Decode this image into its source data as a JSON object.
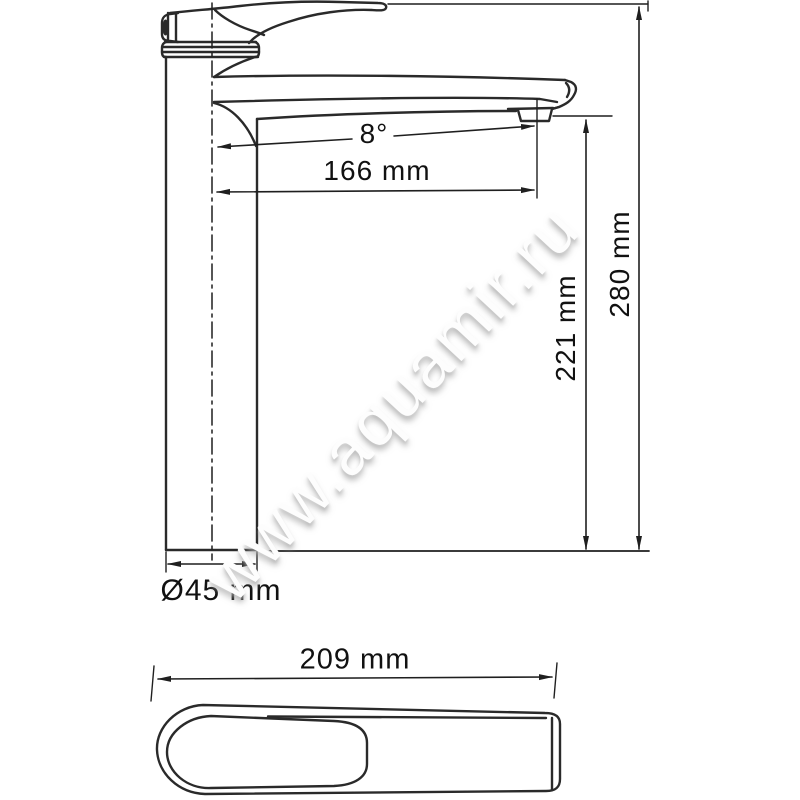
{
  "page": {
    "type": "faucet technical dimension drawing",
    "background": "#ffffff"
  },
  "watermark": {
    "text": "www.aquamir.ru"
  },
  "labels": {
    "spout_angle": "8°",
    "spout_reach": "166 mm",
    "outlet_height": "221 mm",
    "overall_height": "280 mm",
    "base_diameter": "Ø45 mm",
    "overall_length": "209 mm"
  },
  "values": {
    "spout_angle_deg": 8,
    "spout_reach_mm": 166,
    "outlet_height_mm": 221,
    "overall_height_mm": 280,
    "base_diameter_mm": 45,
    "overall_length_mm": 209
  },
  "colors": {
    "line": "#2a2a2a",
    "dimension_line": "#1f1f1f",
    "text": "#111111",
    "watermark_shadow": "#c9c9c9",
    "background": "#ffffff"
  }
}
